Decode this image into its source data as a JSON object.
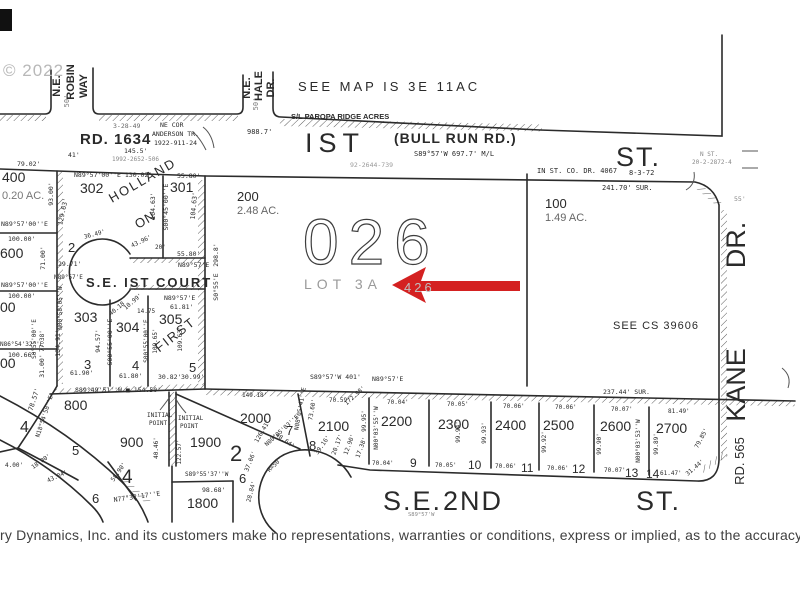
{
  "colors": {
    "ink": "#2a2a2a",
    "faint": "#9a9a9a",
    "red": "#d42121",
    "watermark": "#b8b8b8"
  },
  "annotation_arrow": {
    "shape": "left-arrow",
    "color": "#d42121",
    "points_to": "LOT 3A"
  },
  "disclaimer": "ry Dynamics, Inc. and its customers make no representations, warranties or conditions, express or implied, as to the accuracy or",
  "labels": [
    {
      "t": "© 2022",
      "x": 3,
      "y": 76,
      "s": 17,
      "c": "#b8b8b8",
      "f": "s",
      "ls": 1
    },
    {
      "t": "N.E.",
      "x": 60,
      "y": 86,
      "s": 11,
      "r": -90,
      "a": "m",
      "f": "s",
      "w": 1
    },
    {
      "t": "ROBIN",
      "x": 74,
      "y": 82,
      "s": 11,
      "r": -90,
      "a": "m",
      "f": "s",
      "w": 1
    },
    {
      "t": "WAY",
      "x": 87,
      "y": 86,
      "s": 11,
      "r": -90,
      "a": "m",
      "f": "s",
      "w": 1
    },
    {
      "t": "50'",
      "x": 69,
      "y": 101,
      "s": 7,
      "r": -90,
      "a": "m",
      "c": "#777"
    },
    {
      "t": "N.E.",
      "x": 250,
      "y": 88,
      "s": 11,
      "r": -90,
      "a": "m",
      "f": "s",
      "w": 1
    },
    {
      "t": "HALE",
      "x": 262,
      "y": 86,
      "s": 11,
      "r": -90,
      "a": "m",
      "f": "s",
      "w": 1
    },
    {
      "t": "DR.",
      "x": 274,
      "y": 88,
      "s": 11,
      "r": -90,
      "a": "m",
      "f": "s",
      "w": 1
    },
    {
      "t": "50'",
      "x": 258,
      "y": 104,
      "s": 7,
      "r": -90,
      "a": "m",
      "c": "#777"
    },
    {
      "t": "SEE MAP IS 3E 11AC",
      "x": 298,
      "y": 91,
      "s": 13,
      "f": "s",
      "ls": 3
    },
    {
      "t": "S/L PAROPA RIDGE ACRES",
      "x": 291,
      "y": 119,
      "s": 7.5,
      "f": "s",
      "w": 1
    },
    {
      "t": "3-28-49",
      "x": 113,
      "y": 128,
      "s": 6.5,
      "c": "#666"
    },
    {
      "t": "NE COR",
      "x": 160,
      "y": 127,
      "s": 6.5
    },
    {
      "t": "ANDERSON TR.",
      "x": 152,
      "y": 136,
      "s": 6.5
    },
    {
      "t": "1922-911-24",
      "x": 154,
      "y": 145,
      "s": 6.5
    },
    {
      "t": "RD. 1634",
      "x": 80,
      "y": 144,
      "s": 15,
      "f": "s",
      "w": 1,
      "ls": 1
    },
    {
      "t": "145.5'",
      "x": 124,
      "y": 153,
      "s": 6.5
    },
    {
      "t": "1992-2652-506",
      "x": 112,
      "y": 161,
      "s": 6,
      "c": "#888"
    },
    {
      "t": "988.7'",
      "x": 247,
      "y": 134,
      "s": 7
    },
    {
      "t": "IST",
      "x": 305,
      "y": 152,
      "s": 27,
      "f": "s",
      "ls": 6
    },
    {
      "t": "(BULL RUN RD.)",
      "x": 394,
      "y": 143,
      "s": 14,
      "f": "s",
      "w": 1,
      "ls": 1
    },
    {
      "t": "S89°57'W  697.7'  M/L",
      "x": 414,
      "y": 156,
      "s": 7
    },
    {
      "t": "92-2644-739",
      "x": 350,
      "y": 167,
      "s": 6.5,
      "c": "#999"
    },
    {
      "t": "IN ST. CO. DR. 4067",
      "x": 537,
      "y": 173,
      "s": 7
    },
    {
      "t": "8-3-72",
      "x": 629,
      "y": 175,
      "s": 7
    },
    {
      "t": "ST.",
      "x": 616,
      "y": 166,
      "s": 27,
      "f": "s",
      "ls": 2
    },
    {
      "t": "N ST.",
      "x": 700,
      "y": 156,
      "s": 6,
      "c": "#888"
    },
    {
      "t": "20-2-2872-4",
      "x": 692,
      "y": 164,
      "s": 6,
      "c": "#888"
    },
    {
      "t": "55'",
      "x": 734,
      "y": 201,
      "s": 6.5,
      "c": "#888"
    },
    {
      "t": "241.70'  SUR.",
      "x": 602,
      "y": 190,
      "s": 7
    },
    {
      "t": "79.02'",
      "x": 17,
      "y": 166,
      "s": 6.5
    },
    {
      "t": "41'",
      "x": 68,
      "y": 157,
      "s": 6.5
    },
    {
      "t": "N89°57'00''E  130.02'",
      "x": 74,
      "y": 177,
      "s": 6.5
    },
    {
      "t": "55.80'",
      "x": 177,
      "y": 178,
      "s": 6.5
    },
    {
      "t": "302",
      "x": 80,
      "y": 193,
      "s": 14,
      "f": "s"
    },
    {
      "t": "301",
      "x": 170,
      "y": 192,
      "s": 14,
      "f": "s"
    },
    {
      "t": "HOLLAND",
      "x": 112,
      "y": 203,
      "s": 13,
      "r": -30,
      "f": "s",
      "ls": 2
    },
    {
      "t": "ON",
      "x": 138,
      "y": 229,
      "s": 13,
      "r": -30,
      "f": "s",
      "ls": 1
    },
    {
      "t": "93.00'",
      "x": 53,
      "y": 194,
      "s": 6.5,
      "r": -90,
      "a": "m"
    },
    {
      "t": "129.63'",
      "x": 65,
      "y": 212,
      "s": 6.5,
      "r": -78,
      "a": "m"
    },
    {
      "t": "104.63'",
      "x": 155,
      "y": 206,
      "s": 6.5,
      "r": -90,
      "a": "m"
    },
    {
      "t": "S00°45'00''E",
      "x": 168,
      "y": 207,
      "s": 6.5,
      "r": -90,
      "a": "m"
    },
    {
      "t": "104.63'",
      "x": 196,
      "y": 206,
      "s": 6.5,
      "r": -85,
      "a": "m"
    },
    {
      "t": "400",
      "x": 2,
      "y": 182,
      "s": 14,
      "f": "s"
    },
    {
      "t": "0.20  AC.",
      "x": 2,
      "y": 199,
      "s": 11,
      "f": "s",
      "c": "#777"
    },
    {
      "t": "N89°57'00''E",
      "x": 1,
      "y": 226,
      "s": 6.5
    },
    {
      "t": "100.00'",
      "x": 8,
      "y": 241,
      "s": 6.5
    },
    {
      "t": "600",
      "x": 0,
      "y": 258,
      "s": 14,
      "f": "s"
    },
    {
      "t": "71.00'",
      "x": 45,
      "y": 258,
      "s": 6.5,
      "r": -90,
      "a": "m"
    },
    {
      "t": "29.71'",
      "x": 58,
      "y": 266,
      "s": 6.5
    },
    {
      "t": "2",
      "x": 68,
      "y": 252,
      "s": 13,
      "f": "s"
    },
    {
      "t": "36.49'",
      "x": 95,
      "y": 236,
      "s": 6,
      "r": -15,
      "a": "m"
    },
    {
      "t": "43.96'",
      "x": 142,
      "y": 243,
      "s": 6,
      "r": -25,
      "a": "m"
    },
    {
      "t": "20'",
      "x": 155,
      "y": 249,
      "s": 6
    },
    {
      "t": "55.80'",
      "x": 177,
      "y": 256,
      "s": 6.5
    },
    {
      "t": "N89°57'E",
      "x": 178,
      "y": 267,
      "s": 6.5
    },
    {
      "t": "S.E.  IST  COURT",
      "x": 86,
      "y": 287,
      "s": 13,
      "f": "s",
      "w": 1,
      "ls": 2
    },
    {
      "t": "N89°57'E",
      "x": 54,
      "y": 279,
      "s": 6
    },
    {
      "t": "298.8'",
      "x": 218,
      "y": 255,
      "s": 6.5,
      "r": -90,
      "a": "m"
    },
    {
      "t": "S0°55'E",
      "x": 218,
      "y": 287,
      "s": 6.5,
      "r": -90,
      "a": "m"
    },
    {
      "t": "N89°57'00''E",
      "x": 1,
      "y": 287,
      "s": 6.5
    },
    {
      "t": "100.00'",
      "x": 8,
      "y": 298,
      "s": 6.5
    },
    {
      "t": "00",
      "x": 0,
      "y": 312,
      "s": 14,
      "f": "s"
    },
    {
      "t": "N00°58'05''W",
      "x": 62,
      "y": 308,
      "s": 6,
      "r": -90,
      "a": "m"
    },
    {
      "t": "303",
      "x": 74,
      "y": 322,
      "s": 14,
      "f": "s"
    },
    {
      "t": "134.91'",
      "x": 60,
      "y": 343,
      "s": 6.5,
      "r": -90,
      "a": "m"
    },
    {
      "t": "94.57'",
      "x": 100,
      "y": 341,
      "s": 6.5,
      "r": -90,
      "a": "m"
    },
    {
      "t": "S00°55'00''E",
      "x": 112,
      "y": 342,
      "s": 6.5,
      "r": -90,
      "a": "m"
    },
    {
      "t": "3",
      "x": 84,
      "y": 369,
      "s": 13,
      "f": "s"
    },
    {
      "t": "61.90'",
      "x": 70,
      "y": 375,
      "s": 6.5
    },
    {
      "t": "304",
      "x": 116,
      "y": 332,
      "s": 14,
      "f": "s"
    },
    {
      "t": "4",
      "x": 132,
      "y": 370,
      "s": 13,
      "f": "s"
    },
    {
      "t": "61.80'",
      "x": 119,
      "y": 378,
      "s": 6.5
    },
    {
      "t": "305",
      "x": 159,
      "y": 324,
      "s": 14,
      "f": "s"
    },
    {
      "t": "FIRST",
      "x": 178,
      "y": 338,
      "s": 13,
      "r": -38,
      "a": "m",
      "f": "s",
      "ls": 2
    },
    {
      "t": "5",
      "x": 189,
      "y": 372,
      "s": 13,
      "f": "s"
    },
    {
      "t": "30.82'",
      "x": 158,
      "y": 379,
      "s": 6.5
    },
    {
      "t": "30.99'",
      "x": 181,
      "y": 379,
      "s": 6.5
    },
    {
      "t": "N89°57'E",
      "x": 164,
      "y": 300,
      "s": 6.5
    },
    {
      "t": "61.81'",
      "x": 170,
      "y": 309,
      "s": 6.5
    },
    {
      "t": "14.75",
      "x": 137,
      "y": 313,
      "s": 6
    },
    {
      "t": "40.18",
      "x": 118,
      "y": 310,
      "s": 6,
      "r": -40,
      "a": "m"
    },
    {
      "t": "10.99'",
      "x": 134,
      "y": 303,
      "s": 6,
      "r": -40,
      "a": "m"
    },
    {
      "t": "S00°55'00''E",
      "x": 148,
      "y": 341,
      "s": 6,
      "r": -90,
      "a": "m"
    },
    {
      "t": "109.65'",
      "x": 157,
      "y": 341,
      "s": 6,
      "r": -90,
      "a": "m"
    },
    {
      "t": "109.63'",
      "x": 182,
      "y": 339,
      "s": 6,
      "r": -90,
      "a": "m"
    },
    {
      "t": "S0°55'00''E",
      "x": 36,
      "y": 339,
      "s": 6,
      "r": -90,
      "a": "m"
    },
    {
      "t": "77.38'",
      "x": 44,
      "y": 341,
      "s": 6,
      "r": -90,
      "a": "m"
    },
    {
      "t": "N86°54'32''E",
      "x": 0,
      "y": 346,
      "s": 6
    },
    {
      "t": "100.66'",
      "x": 8,
      "y": 357,
      "s": 6.5
    },
    {
      "t": "00",
      "x": 0,
      "y": 368,
      "s": 14,
      "f": "s"
    },
    {
      "t": "31.00'",
      "x": 44,
      "y": 366,
      "s": 6.5,
      "r": -90,
      "a": "m"
    },
    {
      "t": "S89°49'51''W ■  154.50'",
      "x": 75,
      "y": 392,
      "s": 6.5
    },
    {
      "t": "800",
      "x": 64,
      "y": 410,
      "s": 14,
      "f": "s"
    },
    {
      "t": "78.57'",
      "x": 36,
      "y": 400,
      "s": 6.5,
      "r": -72,
      "a": "m"
    },
    {
      "t": "N18°54'58''E",
      "x": 46,
      "y": 417,
      "s": 6,
      "r": -72,
      "a": "m"
    },
    {
      "t": "4",
      "x": 20,
      "y": 432,
      "s": 16,
      "f": "s"
    },
    {
      "t": "18.00'",
      "x": 42,
      "y": 463,
      "s": 6,
      "r": -35,
      "a": "m"
    },
    {
      "t": "43.04'",
      "x": 58,
      "y": 478,
      "s": 6,
      "r": -25,
      "a": "m"
    },
    {
      "t": "4.00'",
      "x": 5,
      "y": 467,
      "s": 6
    },
    {
      "t": "5",
      "x": 72,
      "y": 455,
      "s": 13,
      "f": "s"
    },
    {
      "t": "6",
      "x": 92,
      "y": 503,
      "s": 13,
      "f": "s"
    },
    {
      "t": "58.90'",
      "x": 120,
      "y": 473,
      "s": 6,
      "r": -55,
      "a": "m"
    },
    {
      "t": "INITIAL",
      "x": 147,
      "y": 417,
      "s": 6
    },
    {
      "t": "POINT",
      "x": 149,
      "y": 425,
      "s": 6
    },
    {
      "t": "INITIAL",
      "x": 178,
      "y": 420,
      "s": 6
    },
    {
      "t": "POINT",
      "x": 180,
      "y": 428,
      "s": 6
    },
    {
      "t": "900",
      "x": 120,
      "y": 447,
      "s": 14,
      "f": "s"
    },
    {
      "t": "4",
      "x": 122,
      "y": 483,
      "s": 19,
      "f": "s"
    },
    {
      "t": "40.46'",
      "x": 158,
      "y": 448,
      "s": 6,
      "r": -90,
      "a": "m"
    },
    {
      "t": "122.57'",
      "x": 181,
      "y": 452,
      "s": 6,
      "r": -90,
      "a": "m"
    },
    {
      "t": "1900",
      "x": 190,
      "y": 447,
      "s": 14,
      "f": "s"
    },
    {
      "t": "2",
      "x": 230,
      "y": 461,
      "s": 22,
      "f": "s"
    },
    {
      "t": "S89°55'37''W",
      "x": 185,
      "y": 476,
      "s": 6
    },
    {
      "t": "98.68'",
      "x": 202,
      "y": 492,
      "s": 6.5
    },
    {
      "t": "1800",
      "x": 187,
      "y": 508,
      "s": 14,
      "f": "s"
    },
    {
      "t": "6",
      "x": 239,
      "y": 483,
      "s": 13,
      "f": "s"
    },
    {
      "t": "N77°32'17''E",
      "x": 114,
      "y": 502,
      "s": 6.5,
      "r": -8
    },
    {
      "t": "37.06'",
      "x": 252,
      "y": 462,
      "s": 6,
      "r": -68,
      "a": "m"
    },
    {
      "t": "R=50'",
      "x": 276,
      "y": 466,
      "s": 6,
      "r": -45,
      "a": "m"
    },
    {
      "t": "28.84'",
      "x": 253,
      "y": 492,
      "s": 6,
      "r": -75,
      "a": "m"
    },
    {
      "t": "126.41'",
      "x": 264,
      "y": 432,
      "s": 6,
      "r": -60,
      "a": "m"
    },
    {
      "t": "48.64'",
      "x": 284,
      "y": 442,
      "s": 6,
      "r": 35,
      "a": "m"
    },
    {
      "t": "200",
      "x": 237,
      "y": 201,
      "s": 13,
      "f": "s"
    },
    {
      "t": "2.48  AC.",
      "x": 237,
      "y": 214,
      "s": 11,
      "f": "s",
      "c": "#666"
    },
    {
      "t": "026",
      "x": 303,
      "y": 264,
      "s": 64,
      "f": "s",
      "ls": 10,
      "o": 1
    },
    {
      "t": "LOT 3A",
      "x": 304,
      "y": 289,
      "s": 14,
      "f": "s",
      "c": "#9a9a9a",
      "ls": 5
    },
    {
      "t": "426",
      "x": 404,
      "y": 292,
      "s": 13,
      "f": "s",
      "c": "#c0c0c0",
      "ls": 3
    },
    {
      "t": "100",
      "x": 545,
      "y": 208,
      "s": 13,
      "f": "s"
    },
    {
      "t": "1.49  AC.",
      "x": 545,
      "y": 221,
      "s": 11,
      "f": "s",
      "c": "#666"
    },
    {
      "t": "SEE CS 39606",
      "x": 613,
      "y": 329,
      "s": 11,
      "f": "s",
      "ls": 1
    },
    {
      "t": "KANE",
      "x": 745,
      "y": 385,
      "s": 27,
      "r": -90,
      "a": "m",
      "f": "s"
    },
    {
      "t": "DR.",
      "x": 745,
      "y": 245,
      "s": 27,
      "r": -90,
      "a": "m",
      "f": "s"
    },
    {
      "t": "RD. 565",
      "x": 744,
      "y": 461,
      "s": 13,
      "r": -90,
      "a": "m",
      "f": "s"
    },
    {
      "t": "S89°57'W  401'",
      "x": 310,
      "y": 379,
      "s": 6.5
    },
    {
      "t": "N89°57'E",
      "x": 372,
      "y": 381,
      "s": 6.5
    },
    {
      "t": "237.44'  SUR.",
      "x": 603,
      "y": 394,
      "s": 6.5
    },
    {
      "t": "149.18'",
      "x": 242,
      "y": 397,
      "s": 6
    },
    {
      "t": "70.59'",
      "x": 329,
      "y": 402,
      "s": 6
    },
    {
      "t": "70.04'",
      "x": 387,
      "y": 404,
      "s": 6
    },
    {
      "t": "70.05'",
      "x": 447,
      "y": 406,
      "s": 6
    },
    {
      "t": "70.06'",
      "x": 503,
      "y": 408,
      "s": 6
    },
    {
      "t": "70.06'",
      "x": 555,
      "y": 409,
      "s": 6
    },
    {
      "t": "70.07'",
      "x": 611,
      "y": 411,
      "s": 6
    },
    {
      "t": "81.49'",
      "x": 668,
      "y": 413,
      "s": 6
    },
    {
      "t": "2000",
      "x": 240,
      "y": 423,
      "s": 14,
      "f": "s"
    },
    {
      "t": "2100",
      "x": 318,
      "y": 431,
      "s": 14,
      "f": "s"
    },
    {
      "t": "2200",
      "x": 381,
      "y": 426,
      "s": 14,
      "f": "s"
    },
    {
      "t": "2300",
      "x": 438,
      "y": 429,
      "s": 14,
      "f": "s"
    },
    {
      "t": "2400",
      "x": 495,
      "y": 430,
      "s": 14,
      "f": "s"
    },
    {
      "t": "2500",
      "x": 543,
      "y": 430,
      "s": 14,
      "f": "s"
    },
    {
      "t": "2600",
      "x": 600,
      "y": 431,
      "s": 14,
      "f": "s"
    },
    {
      "t": "2700",
      "x": 656,
      "y": 433,
      "s": 14,
      "f": "s"
    },
    {
      "t": "7",
      "x": 286,
      "y": 435,
      "s": 13,
      "f": "s"
    },
    {
      "t": "8",
      "x": 309,
      "y": 450,
      "s": 13,
      "f": "s"
    },
    {
      "t": "9",
      "x": 410,
      "y": 467,
      "s": 12,
      "f": "s"
    },
    {
      "t": "10",
      "x": 468,
      "y": 469,
      "s": 12,
      "f": "s"
    },
    {
      "t": "11",
      "x": 521,
      "y": 472,
      "s": 12,
      "f": "s"
    },
    {
      "t": "12",
      "x": 572,
      "y": 473,
      "s": 12,
      "f": "s"
    },
    {
      "t": "13",
      "x": 625,
      "y": 477,
      "s": 12,
      "f": "s"
    },
    {
      "t": "14",
      "x": 646,
      "y": 478,
      "s": 12,
      "f": "s"
    },
    {
      "t": "70.04'",
      "x": 372,
      "y": 465,
      "s": 6
    },
    {
      "t": "70.05'",
      "x": 435,
      "y": 467,
      "s": 6
    },
    {
      "t": "70.06'",
      "x": 495,
      "y": 468,
      "s": 6
    },
    {
      "t": "70.06'",
      "x": 547,
      "y": 470,
      "s": 6
    },
    {
      "t": "70.07'",
      "x": 604,
      "y": 472,
      "s": 6
    },
    {
      "t": "61.47'",
      "x": 660,
      "y": 475,
      "s": 6
    },
    {
      "t": "31.44'",
      "x": 696,
      "y": 469,
      "s": 6,
      "r": -40,
      "a": "m"
    },
    {
      "t": "N08°05'41''E",
      "x": 302,
      "y": 409,
      "s": 6,
      "r": -80,
      "a": "m"
    },
    {
      "t": "73.60'",
      "x": 314,
      "y": 410,
      "s": 6,
      "r": -80,
      "a": "m"
    },
    {
      "t": "99.95'",
      "x": 366,
      "y": 421,
      "s": 6,
      "r": -90,
      "a": "m"
    },
    {
      "t": "N00°03'55''W",
      "x": 378,
      "y": 428,
      "s": 6,
      "r": -90,
      "a": "m"
    },
    {
      "t": "99.94'",
      "x": 460,
      "y": 432,
      "s": 6,
      "r": -90,
      "a": "m"
    },
    {
      "t": "99.93'",
      "x": 486,
      "y": 433,
      "s": 6,
      "r": -90,
      "a": "m"
    },
    {
      "t": "99.92'",
      "x": 546,
      "y": 442,
      "s": 6,
      "r": -90,
      "a": "m"
    },
    {
      "t": "99.90'",
      "x": 601,
      "y": 444,
      "s": 6,
      "r": -90,
      "a": "m"
    },
    {
      "t": "N00°03'53''W",
      "x": 640,
      "y": 441,
      "s": 6,
      "r": -90,
      "a": "m"
    },
    {
      "t": "99.89'",
      "x": 658,
      "y": 444,
      "s": 6,
      "r": -90,
      "a": "m"
    },
    {
      "t": "79.85'",
      "x": 703,
      "y": 439,
      "s": 6,
      "r": -62,
      "a": "m"
    },
    {
      "t": "39.16'",
      "x": 324,
      "y": 446,
      "s": 6,
      "r": -55,
      "a": "m"
    },
    {
      "t": "20.17'",
      "x": 339,
      "y": 445,
      "s": 6,
      "r": -70,
      "a": "m"
    },
    {
      "t": "12.90'",
      "x": 351,
      "y": 445,
      "s": 6,
      "r": -70,
      "a": "m"
    },
    {
      "t": "17.38'",
      "x": 363,
      "y": 448,
      "s": 6,
      "r": -70,
      "a": "m"
    },
    {
      "t": "N00°05'03''E",
      "x": 283,
      "y": 432,
      "s": 6,
      "r": -42,
      "a": "m"
    },
    {
      "t": "172.98'",
      "x": 356,
      "y": 397,
      "s": 6,
      "r": -42,
      "a": "m"
    },
    {
      "t": "S.E.",
      "x": 383,
      "y": 510,
      "s": 27,
      "f": "s",
      "ls": 2
    },
    {
      "t": "2ND",
      "x": 443,
      "y": 510,
      "s": 27,
      "f": "s",
      "ls": 2
    },
    {
      "t": "ST.",
      "x": 636,
      "y": 510,
      "s": 27,
      "f": "s",
      "ls": 2
    },
    {
      "t": "S89°57'W",
      "x": 408,
      "y": 516,
      "s": 5.5,
      "c": "#888"
    }
  ]
}
